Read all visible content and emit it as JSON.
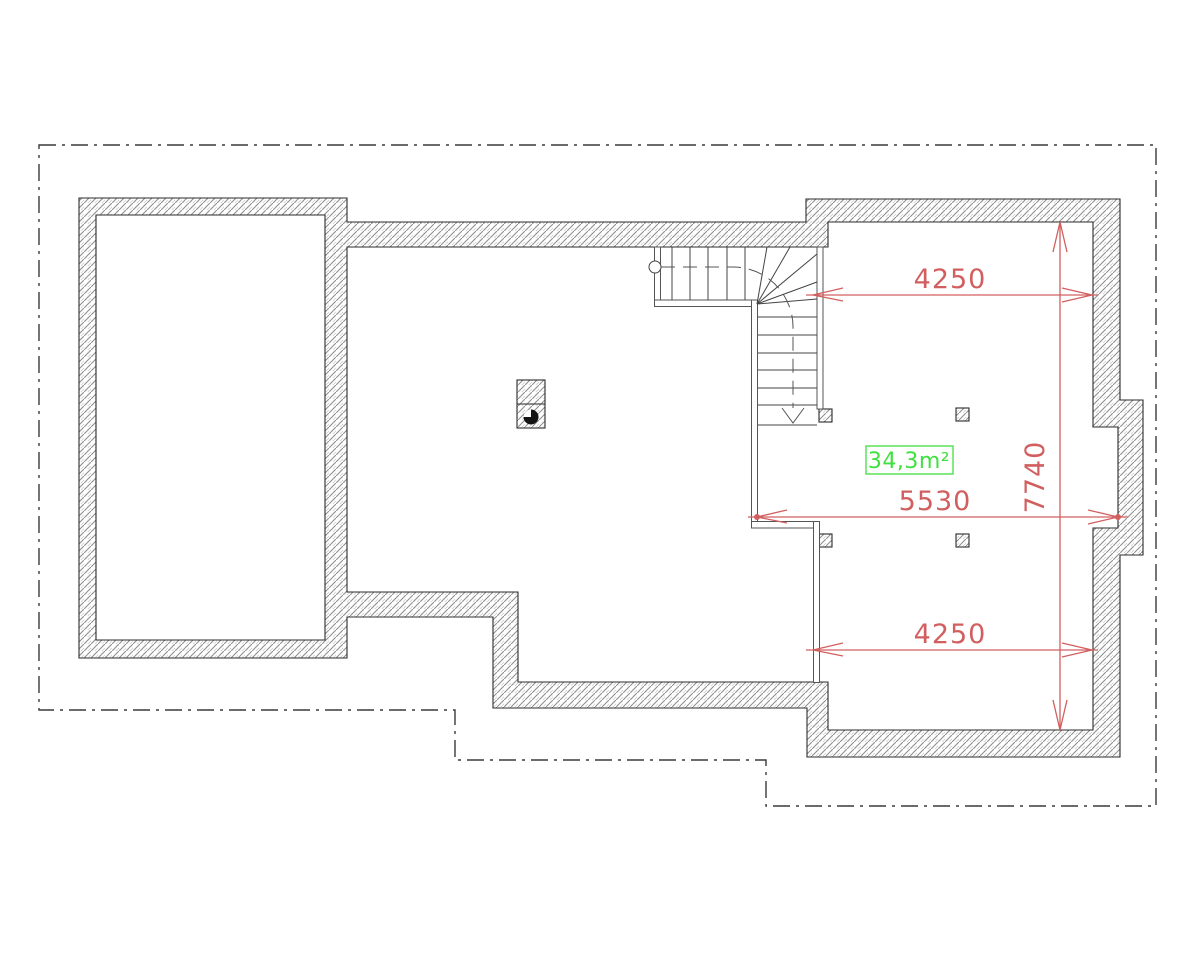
{
  "drawing": {
    "kind": "attic-floor-plan",
    "area_label": {
      "text": "34,3m²"
    },
    "dimensions": {
      "top_width": "4250",
      "plan_width": "5530",
      "right_height": "7740",
      "bottom_width": "4250"
    },
    "colors": {
      "dimension_red": "#d25f5f",
      "area_green": "#3fe03f",
      "hatch_gray": "#8f8f8f",
      "line_dark": "#2b2b2b",
      "thin_wall": "#555555",
      "stair_line": "#444444",
      "outline_gray": "#3a3a3a"
    }
  }
}
